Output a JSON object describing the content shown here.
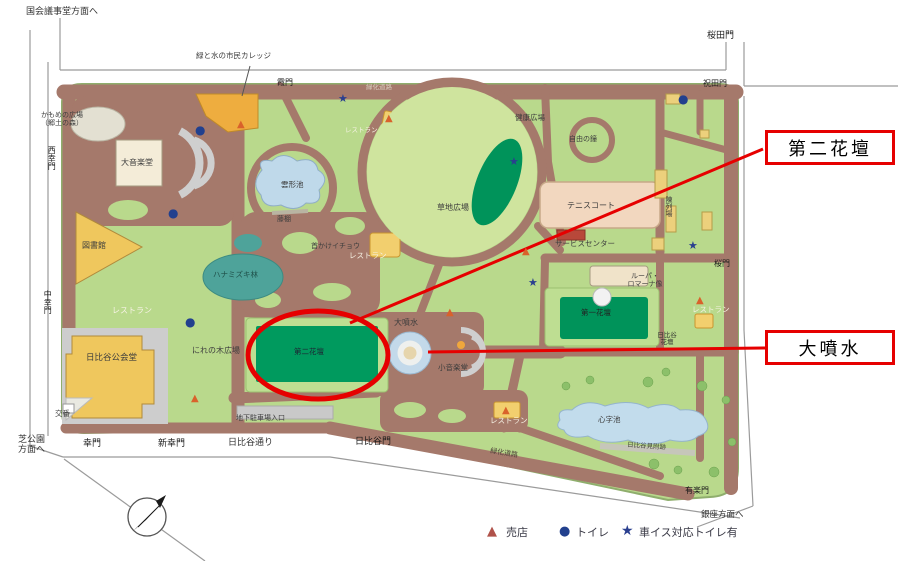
{
  "annotations": {
    "callout_daini_kadan": "第二花壇",
    "callout_daifunsui": "大噴水"
  },
  "directions": {
    "kokkaigijido": "国会議事堂方面へ",
    "shibakoen_line1": "芝公園",
    "shibakoen_line2": "方面へ",
    "ginza": "銀座方面へ"
  },
  "streets": {
    "hibiya_dori": "日比谷通り",
    "ryokuka_doro_top": "緑化道路",
    "ryokuka_doro": "緑化道路"
  },
  "gates": {
    "kasumimon": "霞門",
    "sakuradamon": "桜田門",
    "iwaidamon": "祝田門",
    "nishisaiwaimon": "西幸門",
    "nakasaiwaimon": "中幸門",
    "saiwaimon": "幸門",
    "shinsaiwaimon": "新幸門",
    "hibiyamon": "日比谷門",
    "sakuramon": "桜門",
    "yurakumon": "有楽門"
  },
  "features": {
    "college": "緑と水の市民カレッジ",
    "kamome_line1": "かもめの広場",
    "kamome_line2": "（郷土の森）",
    "daionkakudo": "大音楽堂",
    "toshokan": "図書館",
    "restaurant_nw": "レストラン",
    "kokaido": "日比谷公会堂",
    "koban": "交番",
    "nirenoki_hiroba": "にれの木広場",
    "hanamizuki": "ハナミズキ林",
    "kumogata_ike": "雲形池",
    "fujidana": "藤棚",
    "kubikake_icho": "首かけイチョウ",
    "restaurant_center": "レストラン",
    "restaurant_north": "レストラン",
    "kusachi_hiroba": "草地広場",
    "kenko_hiroba": "健康広場",
    "jiyu_no_kane": "自由の鐘",
    "tennis_court": "テニスコート",
    "service_center": "サービスセンター",
    "chinretsujo": "陳列場",
    "lupa_line1": "ルーパ・",
    "lupa_line2": "ロマーナ像",
    "daiichi_kadan": "第一花壇",
    "restaurant_east": "レストラン",
    "hibiya_kadan_line1": "日比谷",
    "hibiya_kadan_line2": "花壇",
    "daini_kadan": "第二花壇",
    "daifunsui": "大噴水",
    "shoongakudo": "小音楽堂",
    "chika_chushajo": "地下駐車場入口",
    "restaurant_south": "レストラン",
    "shinji_ike": "心字池",
    "hibiya_mitsuke": "日比谷見附跡"
  },
  "legend": {
    "shop_icon": "▲",
    "shop": "売店",
    "toilet_icon": "●",
    "toilet": "トイレ",
    "wheelchair_icon": "★",
    "wheelchair": "車イス対応トイレ有"
  },
  "colors": {
    "road": "#a5796b",
    "lawn": "#b9d98c",
    "dark_green": "#009a5e",
    "pond": "#c2dcec",
    "annotation_red": "#e60000",
    "building_yellow": "#efc75d",
    "tennis_pink": "#f2d7bf",
    "dogwood_teal": "#4ea39a",
    "marker_navy": "#22408e",
    "shop_orange": "#d9622b"
  }
}
